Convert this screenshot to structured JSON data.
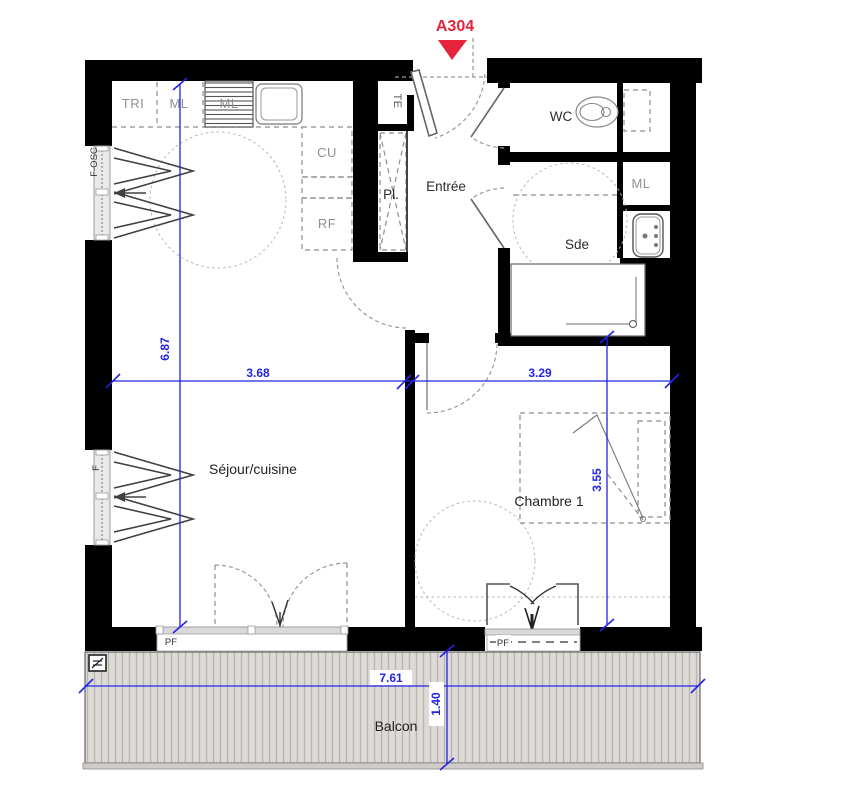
{
  "unit": {
    "label": "A304"
  },
  "rooms": {
    "sejour": "Séjour/cuisine",
    "chambre": "Chambre 1",
    "entree": "Entrée",
    "wc": "WC",
    "sde": "Sde",
    "balcon": "Balcon"
  },
  "closets": {
    "pl": "Pl.",
    "te": "TE",
    "ml_bath": "ML"
  },
  "kitchen": {
    "tri": "TRI",
    "ml1": "ML",
    "ml2": "ML",
    "cu": "CU",
    "rf": "RF"
  },
  "windows": {
    "f_osc": "F-OSC",
    "f": "F",
    "pf_sejour": "PF",
    "pf_chambre": "PF"
  },
  "dimensions": {
    "sejour_height": "6.87",
    "sejour_width": "3.68",
    "chambre_width": "3.29",
    "chambre_height": "3.55",
    "balcon_width": "7.61",
    "balcon_depth": "1.40"
  },
  "colors": {
    "dimension_blue": "#2323e6",
    "marker_red": "#e3243a",
    "wall_black": "#000000"
  }
}
